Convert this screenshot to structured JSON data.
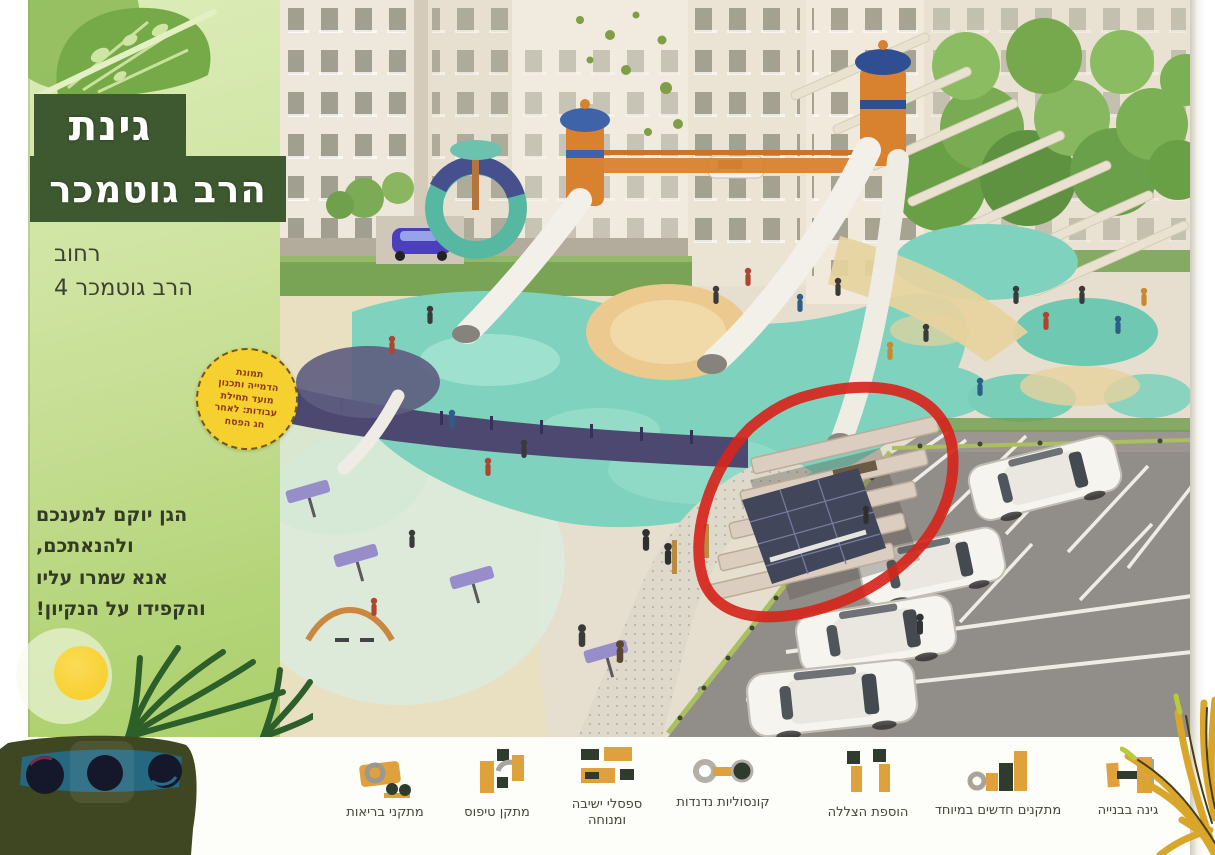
{
  "poster": {
    "panel": {
      "title": {
        "line1": "גינת",
        "line2": "הרב גוטמכר"
      },
      "address": {
        "line1": "רחוב",
        "line2": "הרב גוטמכר 4"
      },
      "badge": {
        "line1": "תמונת",
        "line2": "הדמייה ותכנון",
        "line3": "מועד תחילת",
        "line4": "עבודות: לאחר",
        "line5": "חג הפסח"
      },
      "message": {
        "line1": "הגן יוקם למענכם",
        "line2": "ולהנאתכם,",
        "line3": "אנא שמרו עליו",
        "line4": "והקפידו על הנקיון!"
      }
    },
    "legend": {
      "items": [
        {
          "id": "fitness",
          "label": "מתקני בריאות",
          "icon": "fitness-equipment-icon"
        },
        {
          "id": "climbing",
          "label": "מתקן טיפוס",
          "icon": "climbing-structure-icon"
        },
        {
          "id": "benches",
          "label": "ספסלי ישיבה ומנוחה",
          "icon": "benches-icon"
        },
        {
          "id": "swings",
          "label": "קונסוליות נדנדות",
          "icon": "swing-consoles-icon"
        },
        {
          "id": "shading",
          "label": "הוספת הצללה",
          "icon": "shade-addition-icon"
        },
        {
          "id": "new-equipment",
          "label": "מתקנים חדשים במיוחד",
          "icon": "new-equipment-icon"
        },
        {
          "id": "construction",
          "label": "גינה בבנייה",
          "icon": "garden-under-construction-icon"
        }
      ]
    },
    "annotation": {
      "shape": "hand-drawn-ellipse",
      "color": "#d6251c"
    },
    "colors": {
      "panel_green": "#c3dd90",
      "title_block_green": "#3e5930",
      "badge_yellow": "#f5d02f",
      "legend_orange": "#dfa13c",
      "legend_dark_green": "#2f3b2c",
      "playground_teal": "#7fd2bd",
      "annotation_red": "#d6251c"
    }
  }
}
